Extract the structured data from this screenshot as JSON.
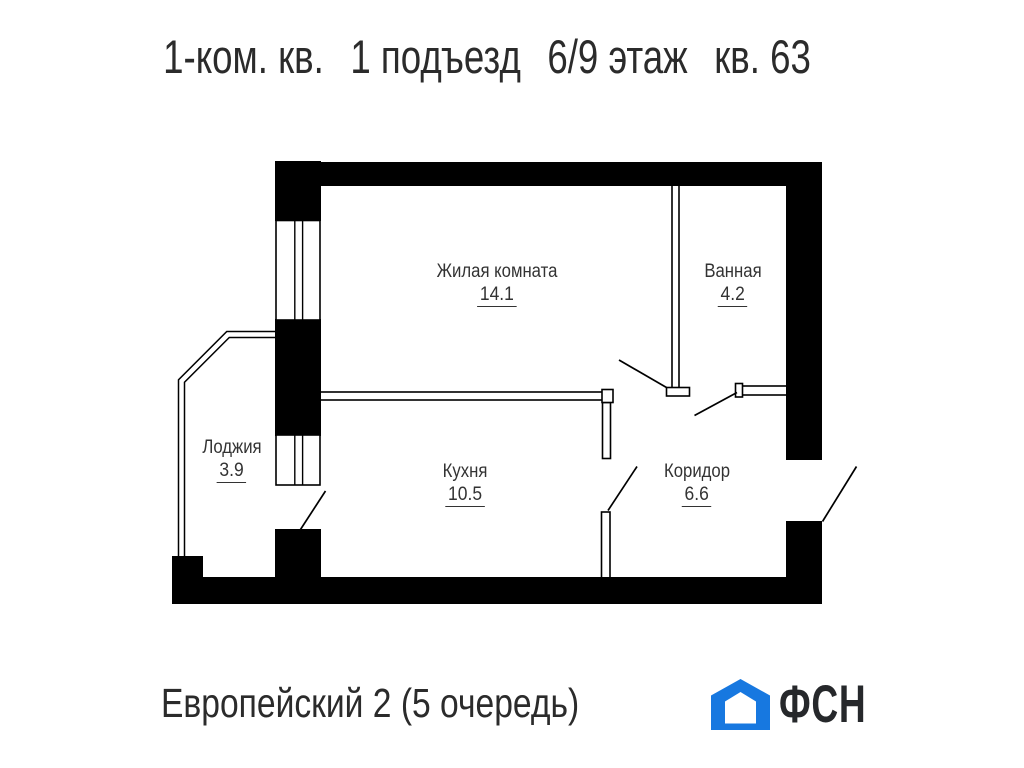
{
  "title": {
    "parts": [
      "1-ком. кв.",
      "1 подъезд",
      "6/9 этаж",
      "кв. 63"
    ]
  },
  "rooms": [
    {
      "name": "Жилая комната",
      "area": "14.1"
    },
    {
      "name": "Ванная",
      "area": "4.2"
    },
    {
      "name": "Лоджия",
      "area": "3.9"
    },
    {
      "name": "Кухня",
      "area": "10.5"
    },
    {
      "name": "Коридор",
      "area": "6.6"
    }
  ],
  "footer": {
    "project": "Европейский 2 (5 очередь)",
    "logo_text": "ФСН"
  },
  "colors": {
    "wall": "#000000",
    "label_text": "#333333",
    "title_text": "#2b2b2b",
    "logo_blue": "#1778e0",
    "logo_dark": "#26282b"
  }
}
